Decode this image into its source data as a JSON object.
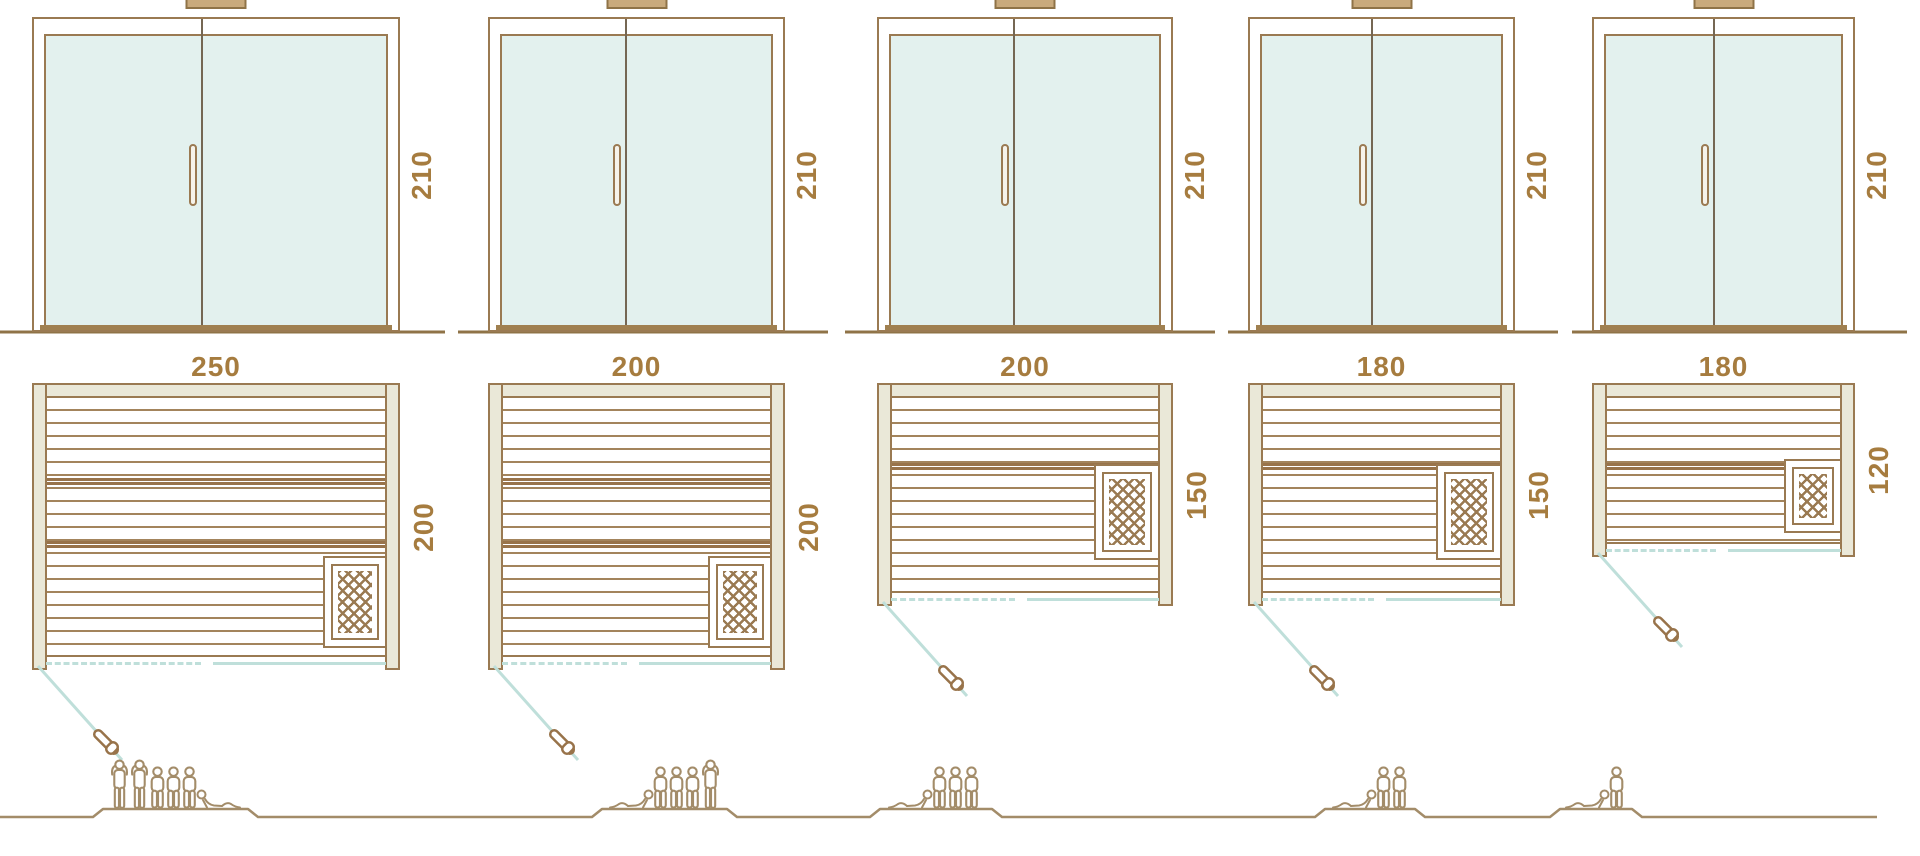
{
  "diagram_title": "Sauna cabin size comparison drawing",
  "palette": {
    "line_brown": "#9a7a52",
    "dark_brown": "#8f7347",
    "wall_fill": "#eae8d8",
    "glass_fill": "#e3f1ee",
    "teal_line": "#bfdfda",
    "label_color": "#a67c3f",
    "people_color": "#a38c69"
  },
  "icons": {
    "heater": "heater-crosshatch-icon",
    "door_swing": "door-swing-icon",
    "door_handle": "door-handle-icon",
    "person_standing": "person-standing-icon",
    "person_sitting": "person-sitting-icon",
    "person_lying": "person-lying-icon"
  },
  "units": [
    {
      "front": {
        "height_label": "210"
      },
      "plan": {
        "width_label": "250",
        "depth_label": "200"
      },
      "capacity": {
        "count": 6,
        "poses": [
          "standing",
          "standing",
          "sitting",
          "sitting",
          "sitting",
          "lying-head-left"
        ]
      }
    },
    {
      "front": {
        "height_label": "210"
      },
      "plan": {
        "width_label": "200",
        "depth_label": "200"
      },
      "capacity": {
        "count": 5,
        "poses": [
          "lying-head-right",
          "sitting",
          "sitting",
          "sitting",
          "standing"
        ]
      }
    },
    {
      "front": {
        "height_label": "210"
      },
      "plan": {
        "width_label": "200",
        "depth_label": "150"
      },
      "capacity": {
        "count": 4,
        "poses": [
          "lying-head-right",
          "sitting",
          "sitting",
          "sitting"
        ]
      }
    },
    {
      "front": {
        "height_label": "210"
      },
      "plan": {
        "width_label": "180",
        "depth_label": "150"
      },
      "capacity": {
        "count": 3,
        "poses": [
          "lying-head-right",
          "sitting",
          "sitting"
        ]
      }
    },
    {
      "front": {
        "height_label": "210"
      },
      "plan": {
        "width_label": "180",
        "depth_label": "120"
      },
      "capacity": {
        "count": 2,
        "poses": [
          "lying-head-right",
          "sitting"
        ]
      }
    }
  ]
}
